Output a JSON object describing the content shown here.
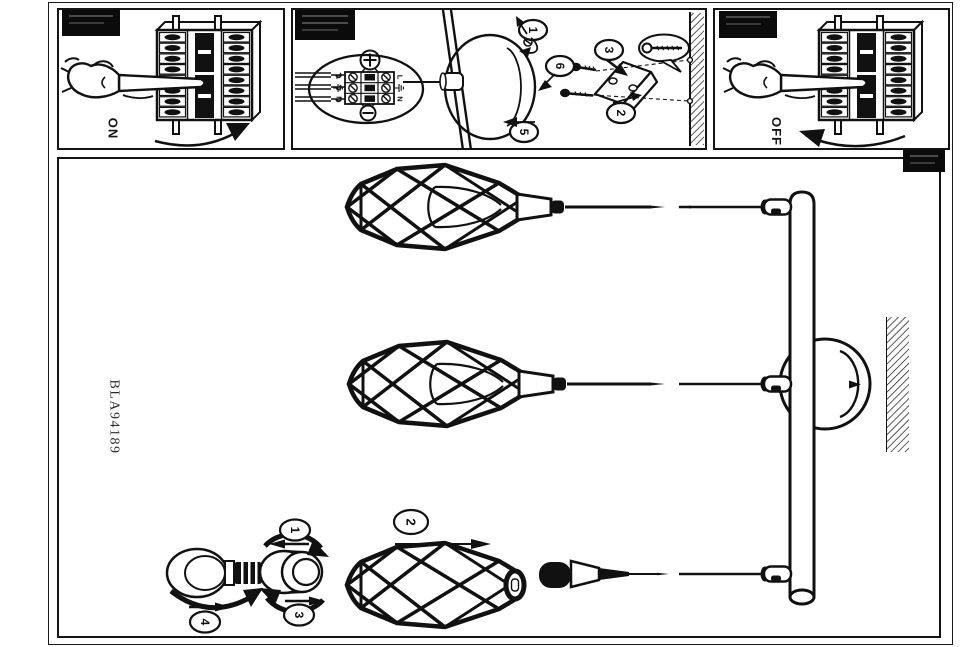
{
  "document": {
    "product_code": "BLA94189"
  },
  "switch_panels": {
    "on_label": "ON",
    "off_label": "OFF"
  },
  "wiring_panel": {
    "terminal": {
      "live": "L",
      "neutral": "N"
    },
    "steps": {
      "step1": "1",
      "step2": "2",
      "step3": "3",
      "step5": "5",
      "step6": "6"
    }
  },
  "assembly_panel": {
    "steps": {
      "step1": "1",
      "step2": "2",
      "step3": "3",
      "step4": "4"
    }
  },
  "colors": {
    "ink": "#111111",
    "paper": "#ffffff"
  }
}
